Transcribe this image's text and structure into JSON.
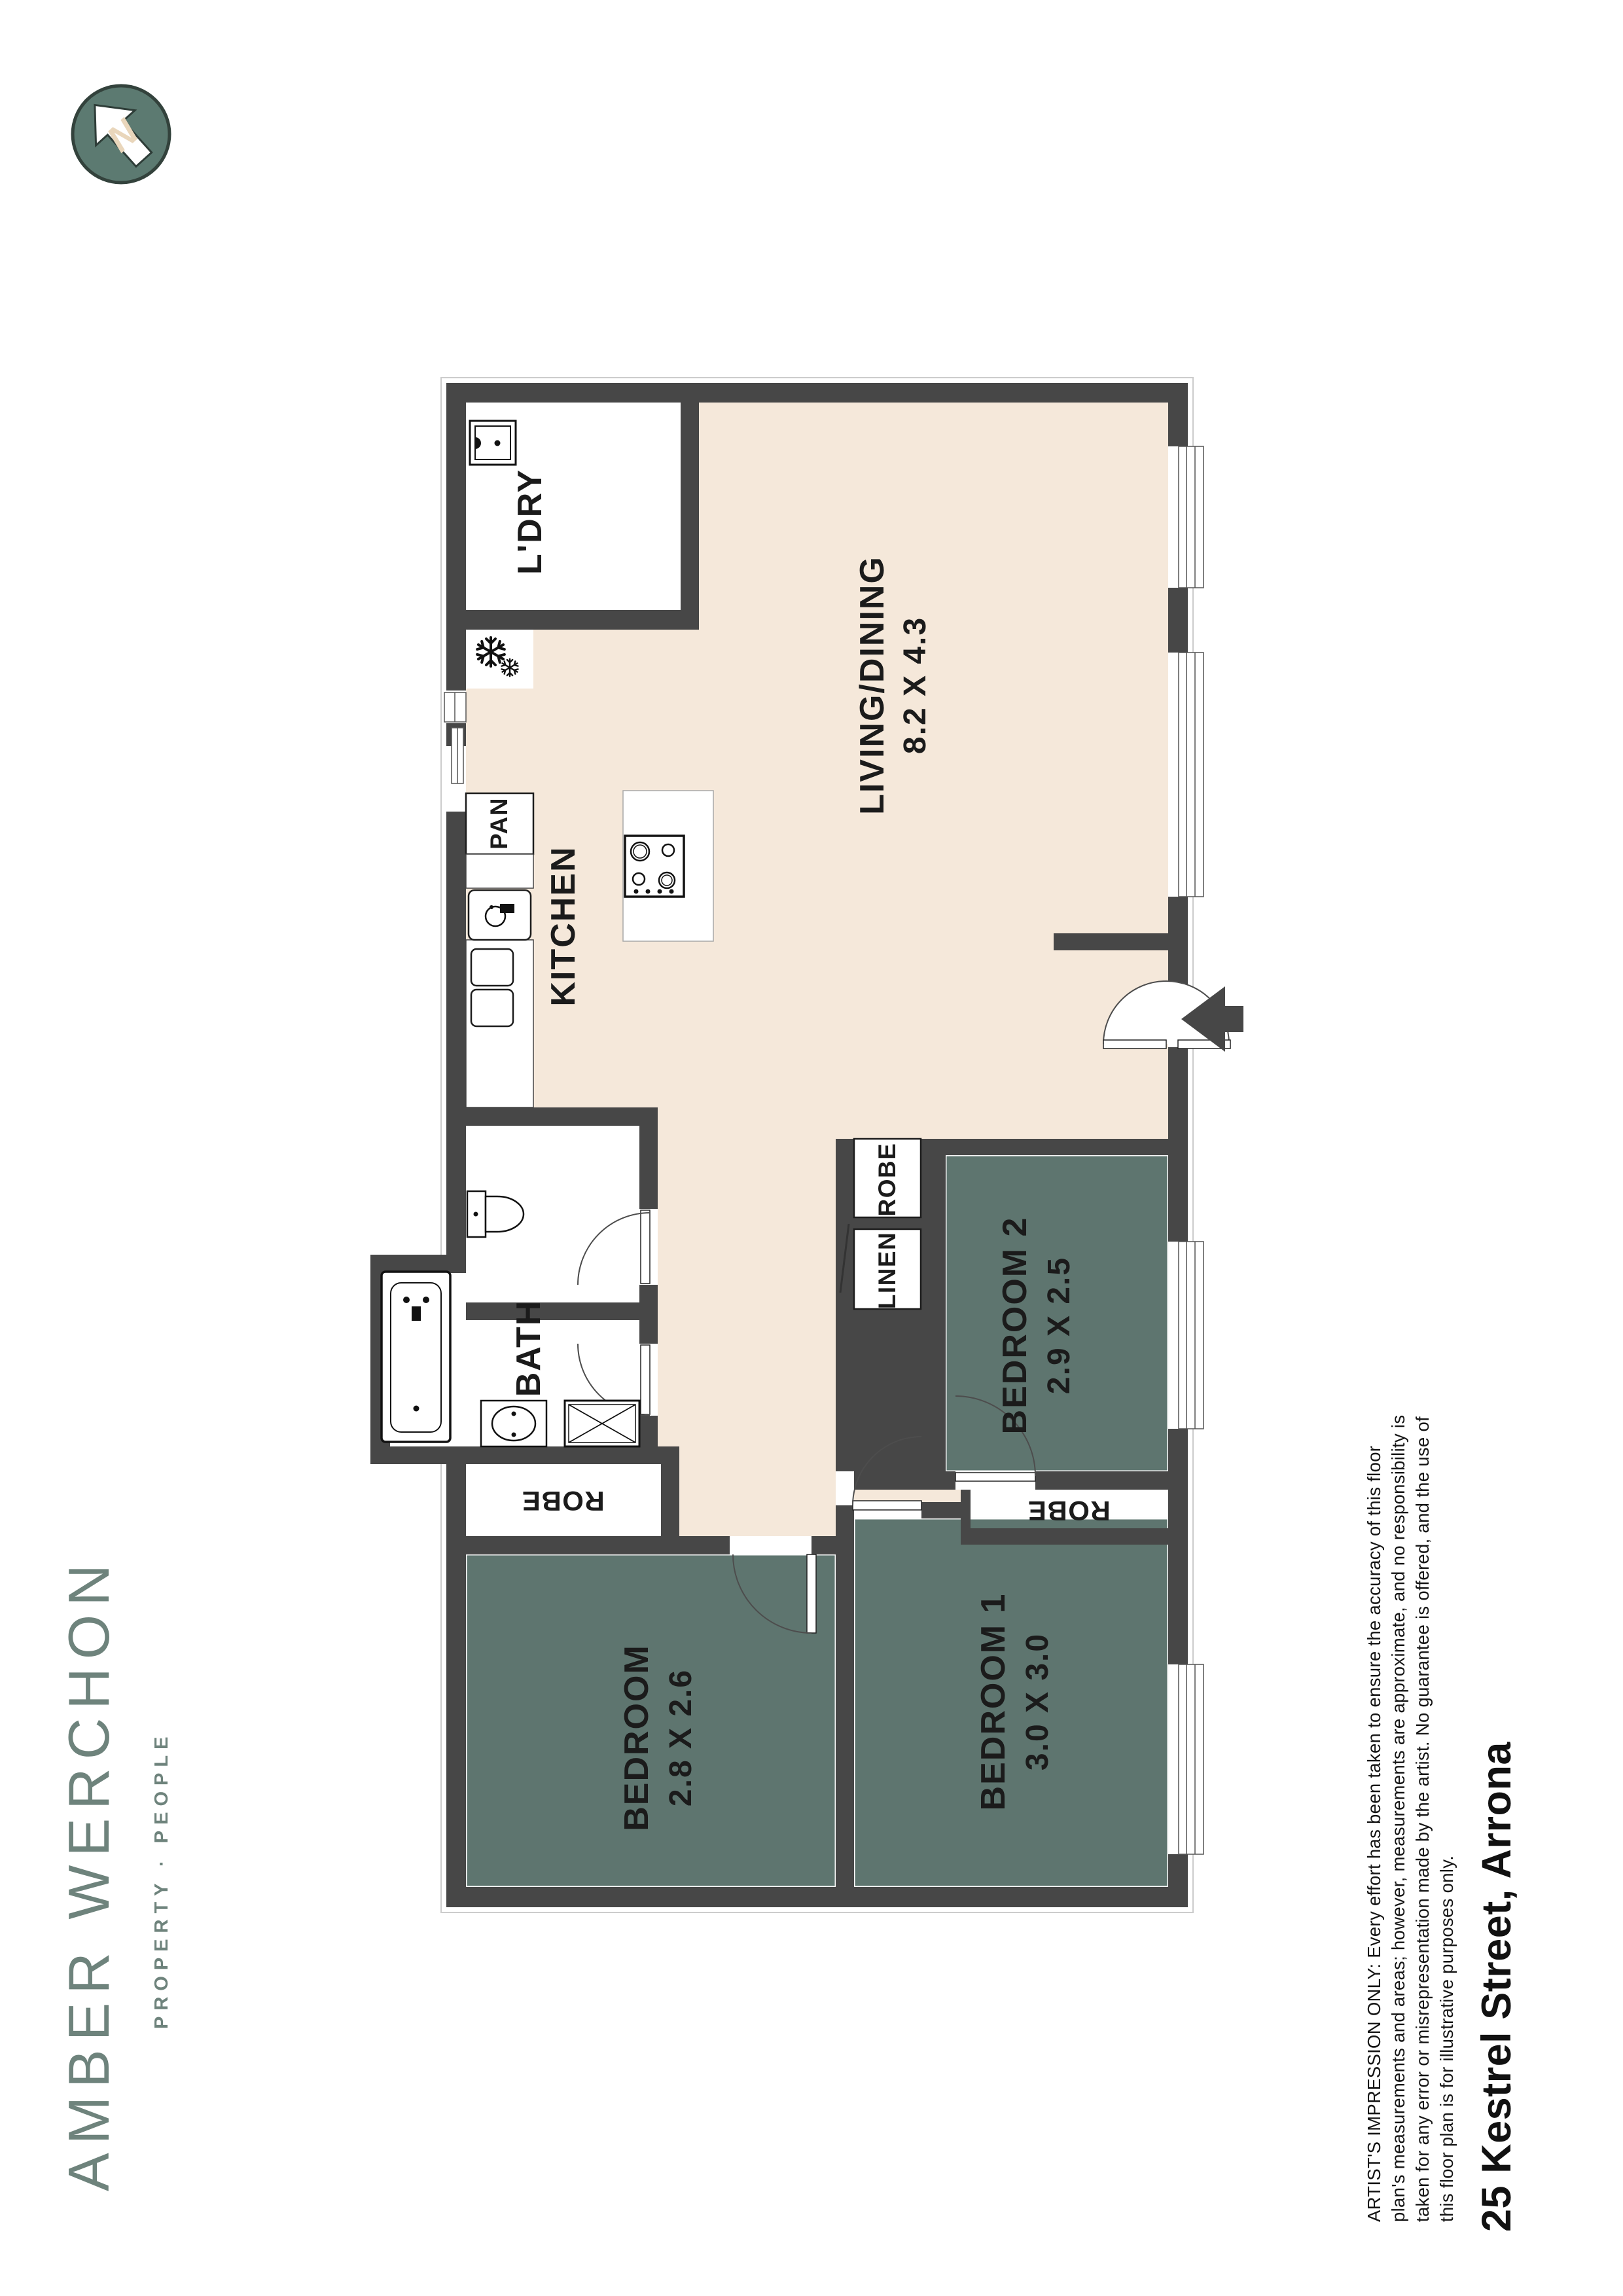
{
  "brand": {
    "name": "AMBER WERCHON",
    "tagline": "PROPERTY · PEOPLE"
  },
  "north": {
    "letter": "N"
  },
  "plan": {
    "rooms": {
      "laundry": {
        "label": "L'DRY"
      },
      "living": {
        "label": "LIVING/DINING",
        "dims": "8.2 X 4.3"
      },
      "kitchen": {
        "label": "KITCHEN"
      },
      "pantry": {
        "label": "PAN"
      },
      "bath": {
        "label": "BATH"
      },
      "bedroom2": {
        "label": "BEDROOM 2",
        "dims": "2.9 X 2.5"
      },
      "bedroom1": {
        "label": "BEDROOM 1",
        "dims": "3.0 X 3.0"
      },
      "bedroom": {
        "label": "BEDROOM",
        "dims": "2.8 X 2.6"
      },
      "linen": {
        "label": "LINEN"
      },
      "robe": {
        "label": "ROBE"
      }
    }
  },
  "footer": {
    "address": "25 Kestrel Street, Arrona",
    "disclaimer_lines": [
      "ARTIST'S IMPRESSION ONLY: Every effort has been taken to ensure the accuracy of this floor",
      "plan's measurements and areas; however, measurements are approximate, and no responsibility is",
      "taken for any error or misrepresentation made by the artist. No guarantee is offered, and the use of",
      "this floor plan is for illustrative purposes only."
    ]
  },
  "colors": {
    "wall": "#474747",
    "bedroom_fill": "#5E756F",
    "living_fill": "#F5E8DA",
    "brand": "#6E837C"
  }
}
